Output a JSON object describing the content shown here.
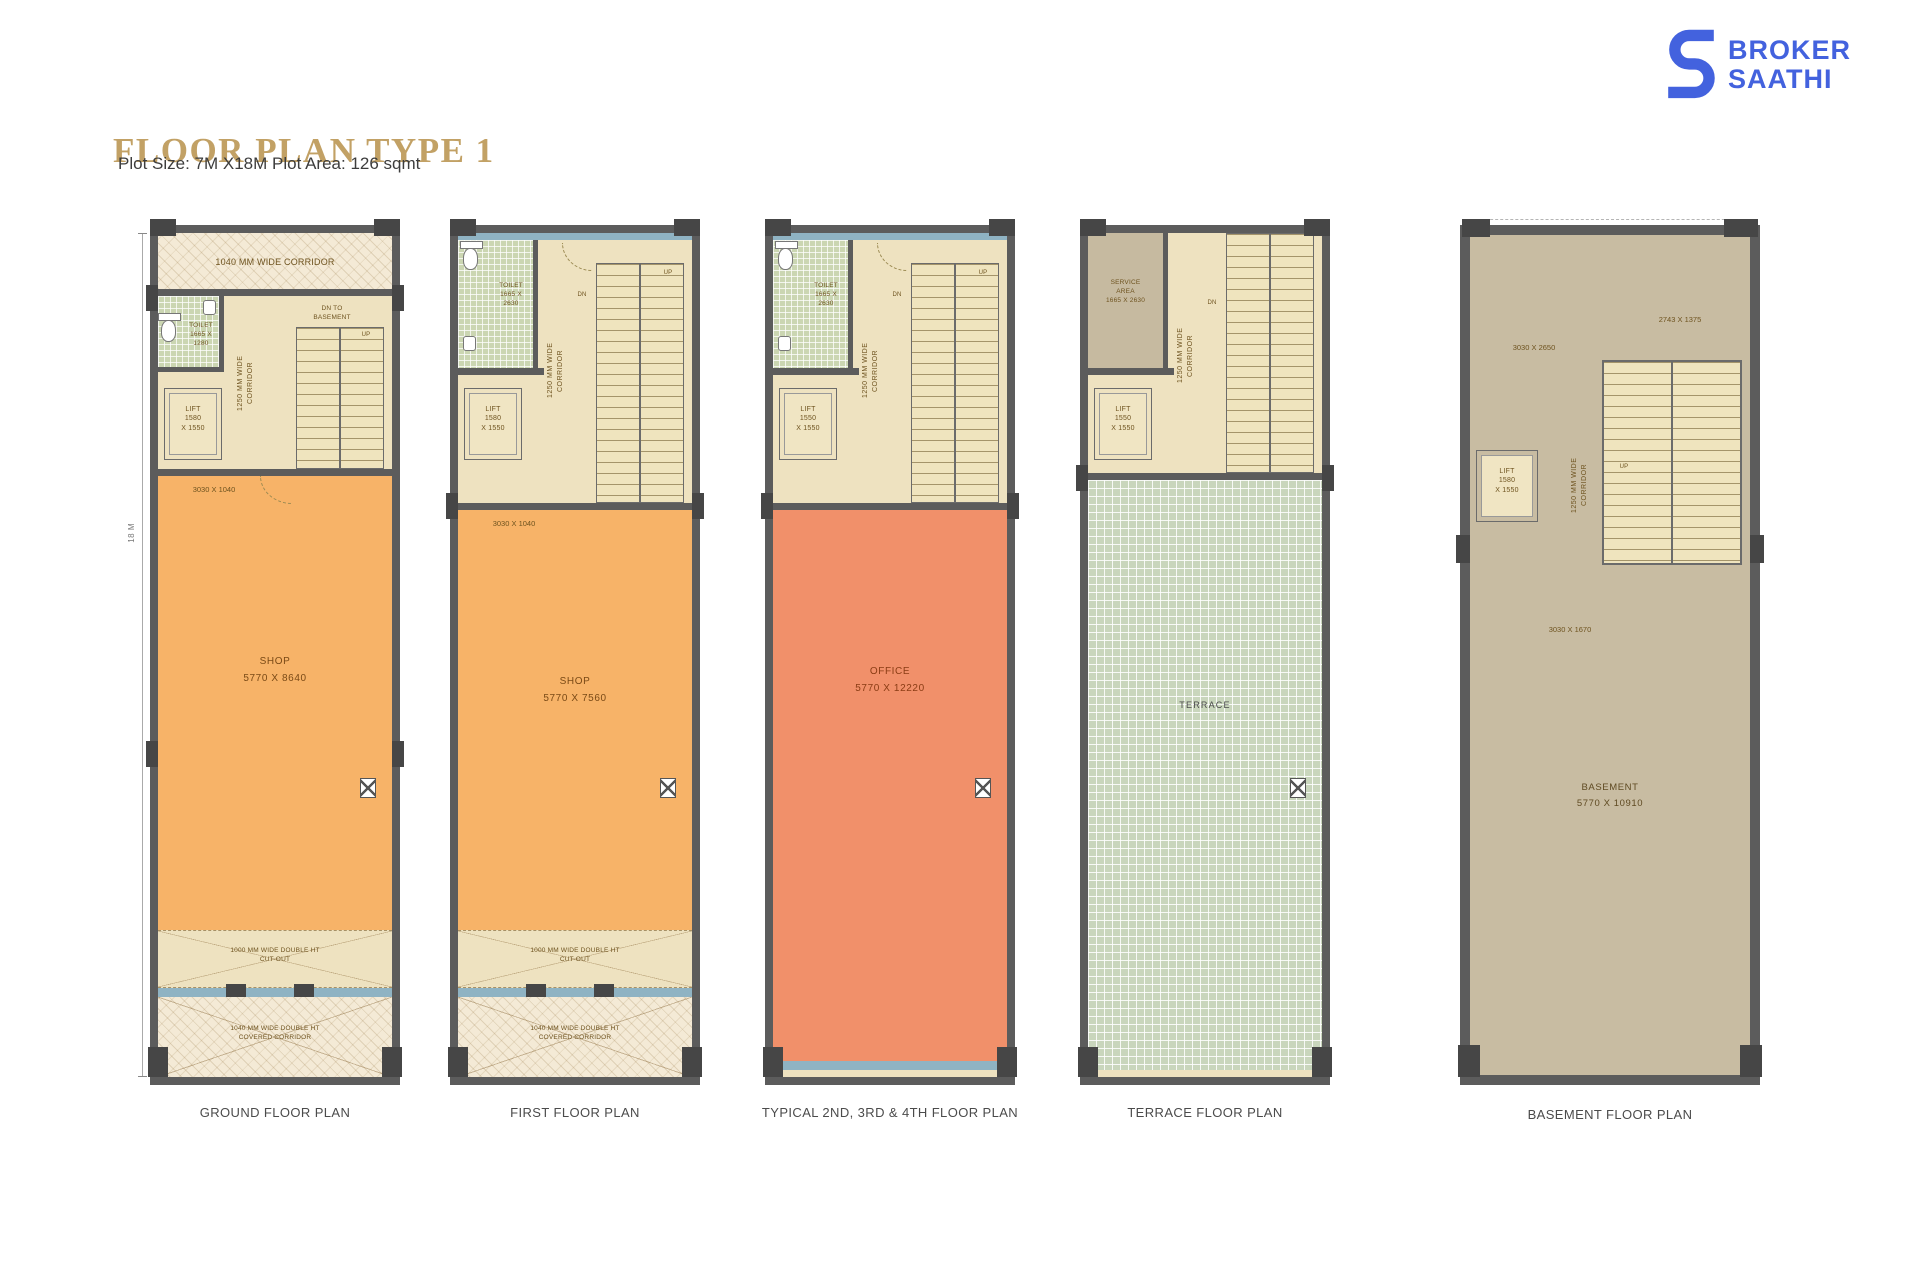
{
  "header": {
    "title": "FLOOR PLAN TYPE 1",
    "subtitle": "Plot Size: 7M X18M Plot Area: 126 sqmt"
  },
  "logo": {
    "line1": "BROKER",
    "line2": "SAATHI"
  },
  "colors": {
    "accent_gold": "#C2A165",
    "brand_blue": "#4362DE",
    "wall_gray": "#5C5C5C",
    "shop_orange": "#F7B368",
    "office_salmon": "#F1906A",
    "terrace_green": "#C9D6BC",
    "basement_tan": "#C8BCA2",
    "glazing_blue": "#8FB3C3",
    "floor_cream": "#EEE2C0"
  },
  "plans": [
    {
      "caption": "GROUND FLOOR PLAN",
      "top_corridor": "1040 MM WIDE CORRIDOR",
      "toilet": "TOILET\n1665 X\n1280",
      "lift": "LIFT\n1580\nX 1550",
      "corridor": "1250 MM WIDE\nCORRIDOR",
      "dn_note": "DN TO\nBASEMENT",
      "up": "UP",
      "dim": "3030 X 1040",
      "room": "SHOP\n5770 X 8640",
      "cutout": "1000 MM WIDE DOUBLE HT\nCUT-OUT",
      "covered": "1040 MM WIDE DOUBLE HT\nCOVERED CORRIDOR",
      "plot_depth": "18 M"
    },
    {
      "caption": "FIRST FLOOR PLAN",
      "toilet": "TOILET\n1665 X\n2630",
      "lift": "LIFT\n1580\nX 1550",
      "corridor": "1250 MM WIDE\nCORRIDOR",
      "dn": "DN",
      "up": "UP",
      "dim": "3030 X 1040",
      "room": "SHOP\n5770 X 7560",
      "cutout": "1000 MM WIDE DOUBLE HT\nCUT-OUT",
      "covered": "1040 MM WIDE DOUBLE HT\nCOVERED CORRIDOR"
    },
    {
      "caption": "TYPICAL 2ND, 3RD & 4TH FLOOR PLAN",
      "toilet": "TOILET\n1665 X\n2630",
      "lift": "LIFT\n1550\nX 1550",
      "corridor": "1250 MM WIDE\nCORRIDOR",
      "dn": "DN",
      "up": "UP",
      "room": "OFFICE\n5770 X 12220"
    },
    {
      "caption": "TERRACE FLOOR PLAN",
      "service": "SERVICE\nAREA\n1665 X 2630",
      "lift": "LIFT\n1550\nX 1550",
      "corridor": "1250 MM WIDE\nCORRIDOR",
      "dn": "DN",
      "room": "TERRACE"
    },
    {
      "caption": "BASEMENT FLOOR PLAN",
      "dim_top": "2743 X 1375",
      "dim_left": "3030 X 2650",
      "lift": "LIFT\n1580\nX 1550",
      "corridor": "1250 MM WIDE\nCORRIDOR",
      "up": "UP",
      "dim_mid": "3030 X 1670",
      "room": "BASEMENT\n5770 X 10910"
    }
  ]
}
